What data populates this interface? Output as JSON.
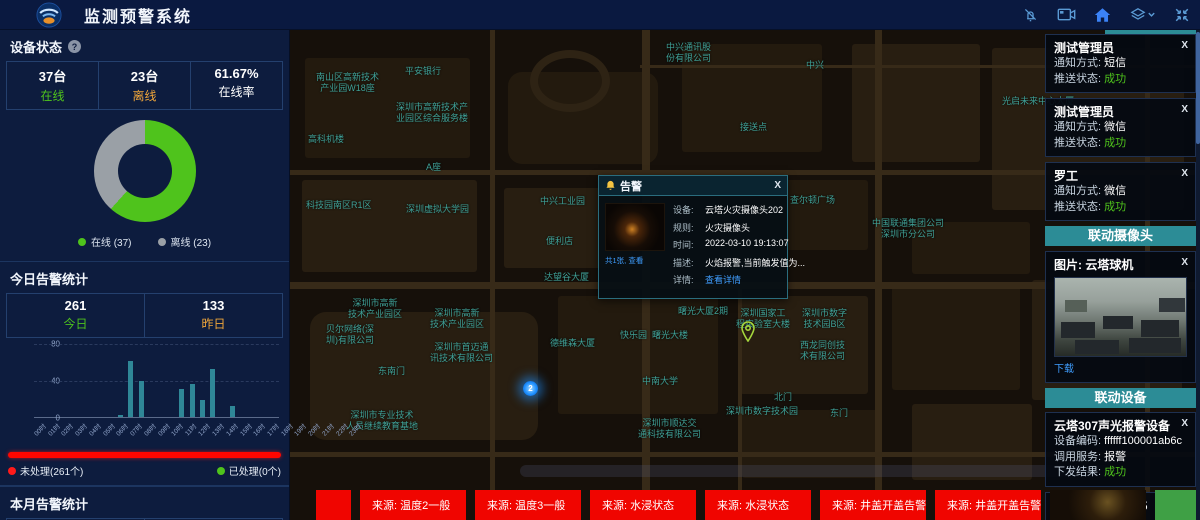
{
  "app": {
    "title": "监测预警系统"
  },
  "left_panel": {
    "device_status": {
      "title": "设备状态",
      "stats": [
        {
          "value": "37台",
          "label": "在线"
        },
        {
          "value": "23台",
          "label": "离线"
        },
        {
          "value": "61.67%",
          "label": "在线率"
        }
      ],
      "donut": {
        "type": "pie",
        "slices": [
          {
            "label": "在线",
            "value": 37,
            "color": "#4fc31c"
          },
          {
            "label": "离线",
            "value": 23,
            "color": "#9aa0a6"
          }
        ],
        "legend": [
          "在线 (37)",
          "离线 (23)"
        ]
      }
    },
    "today_alarms": {
      "title": "今日告警统计",
      "stats": [
        {
          "value": "261",
          "label": "今日"
        },
        {
          "value": "133",
          "label": "昨日"
        }
      ],
      "bar_chart": {
        "type": "bar",
        "categories": [
          "00时",
          "01时",
          "02时",
          "03时",
          "04时",
          "05时",
          "06时",
          "07时",
          "08时",
          "09时",
          "10时",
          "11时",
          "12时",
          "13时",
          "14时",
          "15时",
          "16时",
          "17时",
          "18时",
          "19时",
          "20时",
          "21时",
          "22时",
          "23时"
        ],
        "values": [
          0,
          0,
          0,
          0,
          0,
          0,
          0,
          0,
          2,
          61,
          40,
          0,
          0,
          0,
          31,
          36,
          19,
          53,
          0,
          12,
          0,
          0,
          0,
          0
        ],
        "ylim": [
          0,
          80
        ],
        "yticks": [
          "0",
          "40",
          "80"
        ],
        "bar_color": "#2f8797"
      },
      "progress": {
        "unhandled_label": "未处理(261个)",
        "handled_label": "已处理(0个)"
      }
    },
    "month_alarms": {
      "title": "本月告警统计",
      "stats": [
        {
          "value": "763"
        },
        {
          "value": "1146"
        }
      ]
    }
  },
  "map": {
    "labels": [
      {
        "text": "中兴通讯股\n份有限公司",
        "x": 376,
        "y": 12
      },
      {
        "text": "平安银行",
        "x": 115,
        "y": 36
      },
      {
        "text": "南山区高新技术\n产业园W18座",
        "x": 26,
        "y": 42
      },
      {
        "text": "中兴",
        "x": 516,
        "y": 30
      },
      {
        "text": "光启未来中心大厦",
        "x": 712,
        "y": 66
      },
      {
        "text": "深圳市高新技术产\n业园区综合服务楼",
        "x": 106,
        "y": 72
      },
      {
        "text": "高科机楼",
        "x": 18,
        "y": 104
      },
      {
        "text": "接送点",
        "x": 450,
        "y": 92
      },
      {
        "text": "A座",
        "x": 136,
        "y": 132
      },
      {
        "text": "科技园南区R1区",
        "x": 16,
        "y": 170
      },
      {
        "text": "深圳虚拟大学园",
        "x": 116,
        "y": 174
      },
      {
        "text": "中兴工业园",
        "x": 250,
        "y": 166
      },
      {
        "text": "查尔顿广场",
        "x": 500,
        "y": 165
      },
      {
        "text": "中国联通集团公司\n深圳市分公司",
        "x": 582,
        "y": 188
      },
      {
        "text": "便利店",
        "x": 256,
        "y": 206
      },
      {
        "text": "达望谷大厦",
        "x": 254,
        "y": 242
      },
      {
        "text": "德维森大厦",
        "x": 260,
        "y": 308
      },
      {
        "text": "曙光大厦2期",
        "x": 388,
        "y": 276
      },
      {
        "text": "快乐园",
        "x": 330,
        "y": 300
      },
      {
        "text": "曙光大楼",
        "x": 362,
        "y": 300
      },
      {
        "text": "深圳国家工\n程实验室大楼",
        "x": 446,
        "y": 278
      },
      {
        "text": "深圳市数字\n技术园B区",
        "x": 512,
        "y": 278
      },
      {
        "text": "西龙同创技\n术有限公司",
        "x": 510,
        "y": 310
      },
      {
        "text": "深圳市高新\n技术产业园区",
        "x": 58,
        "y": 268
      },
      {
        "text": "深圳市高新\n技术产业园区",
        "x": 140,
        "y": 278
      },
      {
        "text": "贝尔网络(深\n圳)有限公司",
        "x": 36,
        "y": 294
      },
      {
        "text": "深圳市首迈通\n讯技术有限公司",
        "x": 140,
        "y": 312
      },
      {
        "text": "东南门",
        "x": 88,
        "y": 336
      },
      {
        "text": "中南大学",
        "x": 352,
        "y": 346
      },
      {
        "text": "北门",
        "x": 484,
        "y": 362
      },
      {
        "text": "深圳市数字技术园",
        "x": 436,
        "y": 376
      },
      {
        "text": "东门",
        "x": 540,
        "y": 378
      },
      {
        "text": "深圳市专业技术\n人员继续教育基地",
        "x": 56,
        "y": 380
      },
      {
        "text": "深圳市顺达交\n通科技有限公司",
        "x": 348,
        "y": 388
      }
    ],
    "cluster_count": "2"
  },
  "popup": {
    "title": "告警",
    "thumb_caption": "共1张, 查看",
    "fields": [
      {
        "label": "设备:",
        "value": "云塔火灾摄像头202"
      },
      {
        "label": "规则:",
        "value": "火灾摄像头"
      },
      {
        "label": "时间:",
        "value": "2022-03-10 19:13:07"
      },
      {
        "label": "描述:",
        "value": "火焰报警,当前触发值为..."
      },
      {
        "label": "详情:",
        "value": "查看详情",
        "link": true
      }
    ],
    "close_label": "X"
  },
  "right_panel": {
    "notifications": [
      {
        "name": "测试管理员",
        "rows": [
          {
            "label": "通知方式: ",
            "value": "短信"
          },
          {
            "label": "推送状态: ",
            "value": "成功",
            "success": true
          }
        ]
      },
      {
        "name": "测试管理员",
        "rows": [
          {
            "label": "通知方式: ",
            "value": "微信"
          },
          {
            "label": "推送状态: ",
            "value": "成功",
            "success": true
          }
        ]
      },
      {
        "name": "罗工",
        "rows": [
          {
            "label": "通知方式: ",
            "value": "微信"
          },
          {
            "label": "推送状态: ",
            "value": "成功",
            "success": true
          }
        ]
      }
    ],
    "camera_section": {
      "header": "联动摄像头",
      "card_title": "图片: 云塔球机",
      "download_label": "下载"
    },
    "device_section": {
      "header": "联动设备",
      "devices": [
        {
          "name": "云塔307声光报警设备",
          "rows": [
            {
              "label": "设备编码: ",
              "value": "ffffff100001ab6c"
            },
            {
              "label": "调用服务: ",
              "value": "报警"
            },
            {
              "label": "下发结果: ",
              "value": "成功",
              "success": true
            }
          ]
        },
        {
          "name": "SIP壁挂音箱1105",
          "rows": [
            {
              "label": "设备编码: ",
              "value": "1105"
            }
          ]
        }
      ]
    },
    "close_label": "X"
  },
  "ticker": {
    "items": [
      "来源: 温度2一般",
      "来源: 温度3一般",
      "来源: 水浸状态",
      "来源: 水浸状态",
      "来源: 井盖开盖告警",
      "来源: 井盖开盖告警"
    ]
  }
}
